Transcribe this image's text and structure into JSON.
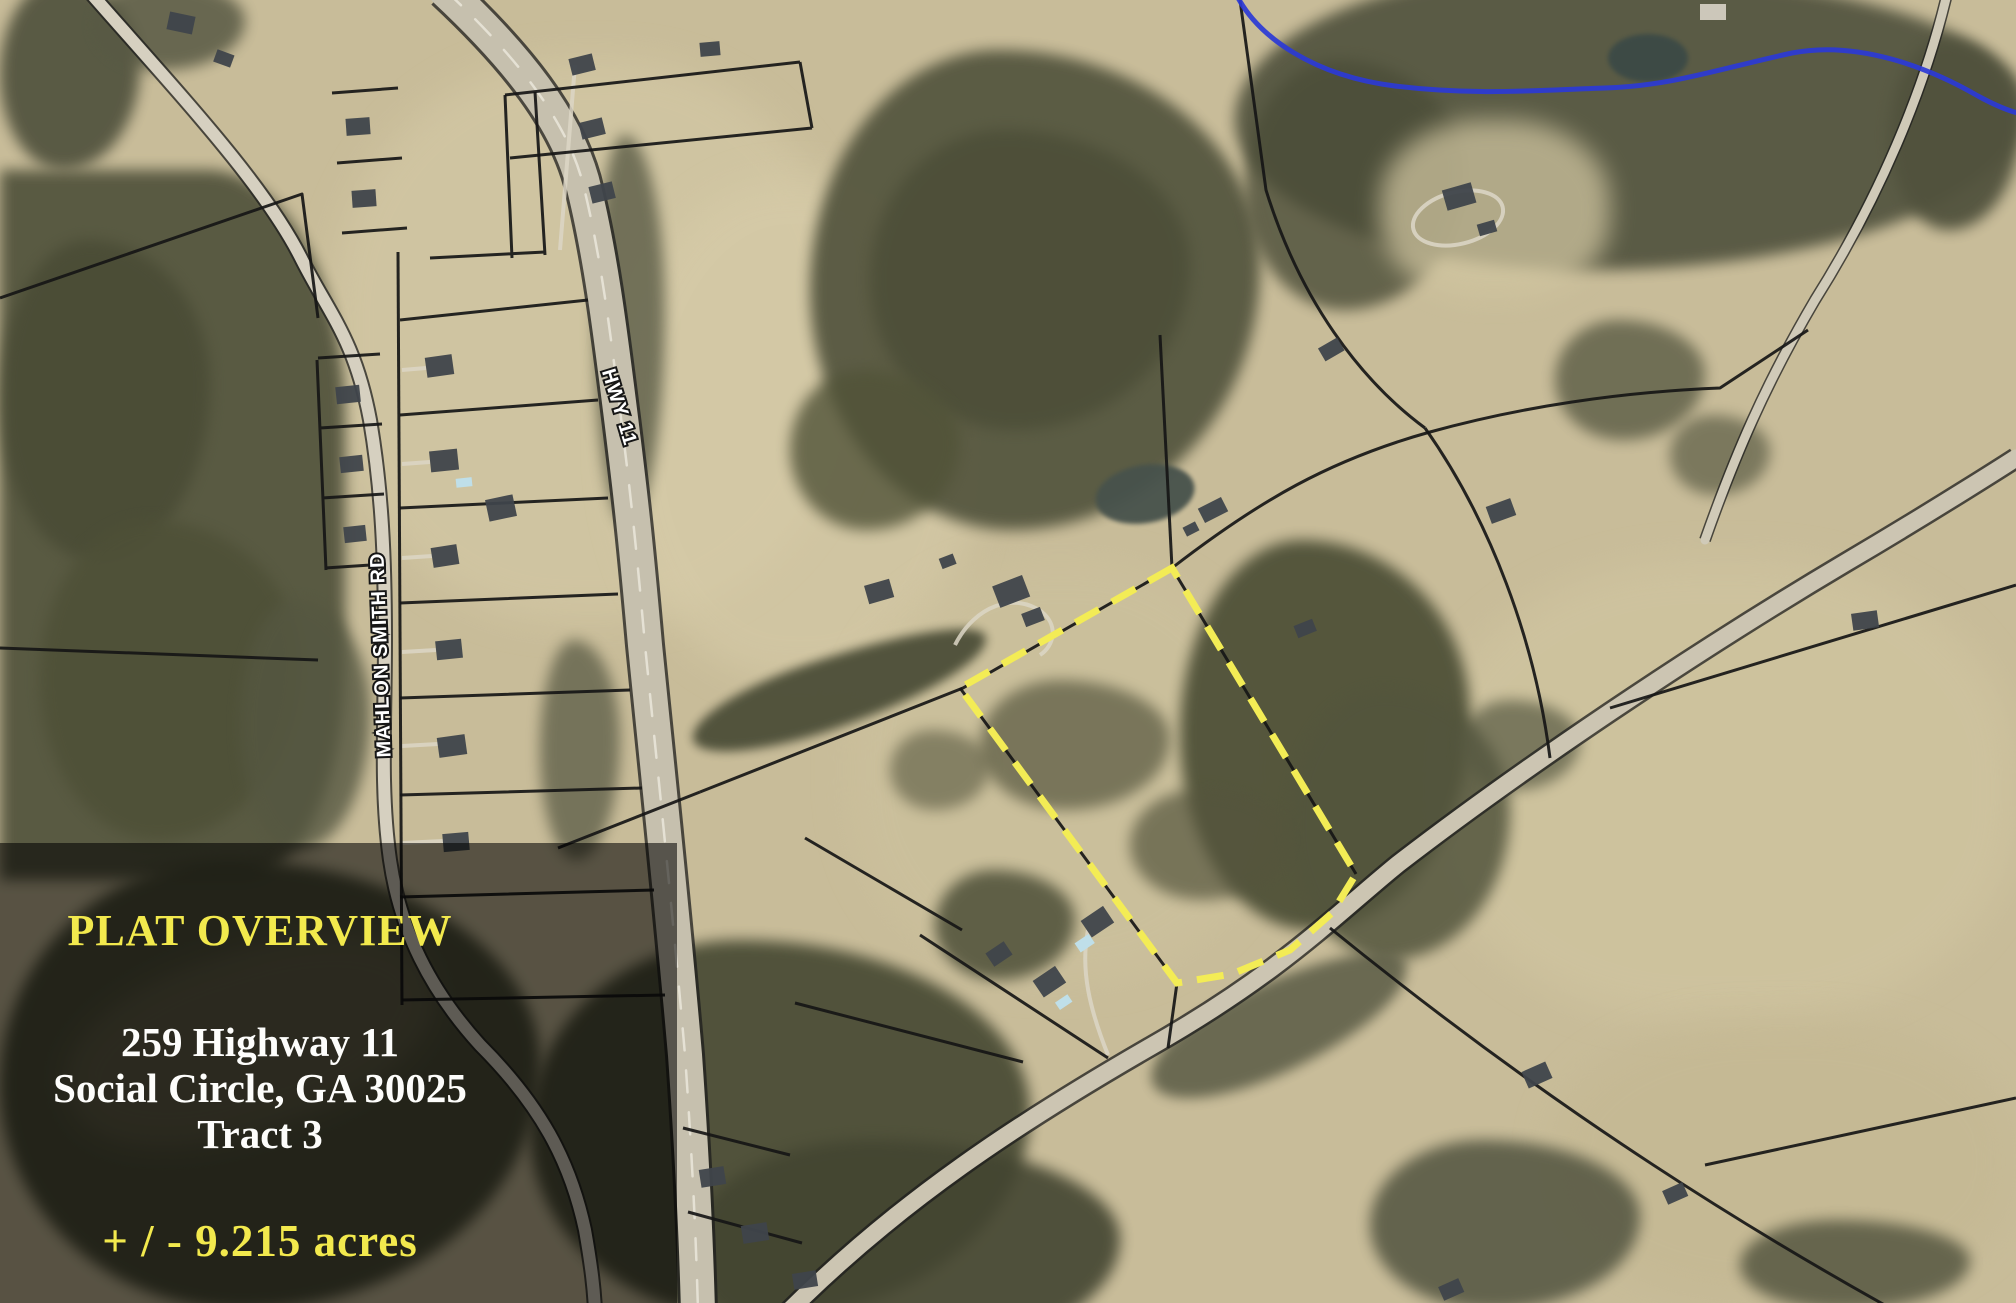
{
  "map": {
    "labels": {
      "road_vertical": "MAHLON SMITH RD",
      "highway": "HWY 11"
    }
  },
  "tract": {
    "outline_points": "1172,568 960,688 1177,983 1232,974 1290,950 1332,913 1356,874",
    "outline_color": "#f3ec55"
  },
  "stream": {
    "path": "M 1236,-6 C 1258,38 1315,76 1395,86 C 1478,96 1540,90 1605,88 C 1672,86 1722,68 1792,53 C 1858,40 1930,68 1978,96 C 2000,108 2012,112 2022,114",
    "color": "#2b3ad6"
  },
  "overlay": {
    "title": "PLAT OVERVIEW",
    "address_line1": "259 Highway 11",
    "address_line2": "Social Circle, GA  30025",
    "address_line3": "Tract 3",
    "acreage": "+ / - 9.215 acres",
    "title_color": "#f2e94d",
    "text_color": "#ffffff",
    "panel_color": "rgba(0,0,0,0.56)"
  }
}
